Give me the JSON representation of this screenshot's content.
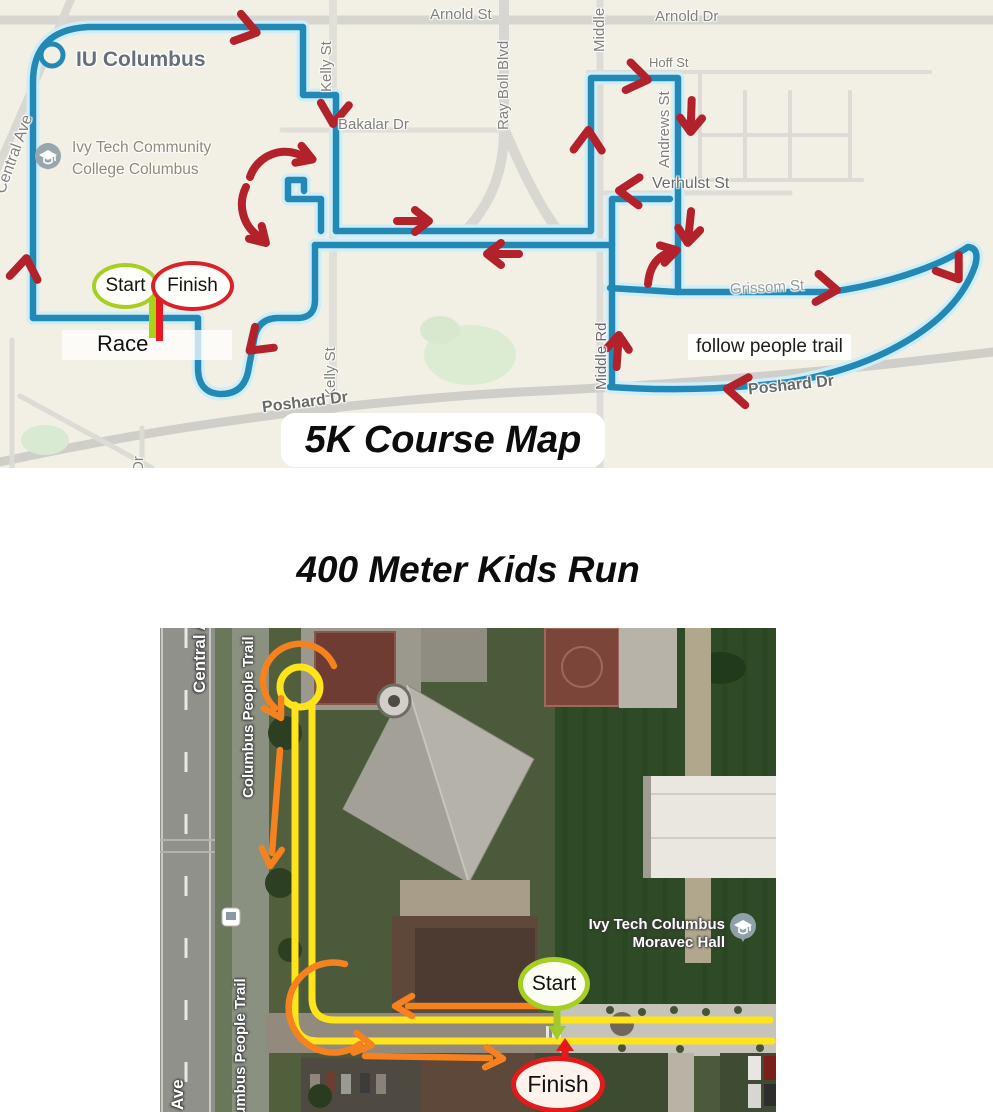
{
  "course_map": {
    "title": "5K Course Map",
    "places": {
      "iu_columbus": "IU Columbus",
      "ivy_tech": "Ivy Tech Community College Columbus",
      "race": "Race",
      "follow_people_trail": "follow people trail"
    },
    "streets": {
      "arnold_st": "Arnold St",
      "arnold_dr": "Arnold Dr",
      "central_ave": "Central Ave",
      "kelly_st_north": "Kelly St",
      "kelly_st_south": "Kelly St",
      "bakalar_dr": "Bakalar Dr",
      "ray_boll_blvd": "Ray Boll Blvd",
      "middle_partial": "Middle",
      "hoff_st": "Hoff St",
      "andrews_st": "Andrews St",
      "verhulst_st": "Verhulst St",
      "grissom_st": "Grissom St",
      "middle_rd": "Middle Rd",
      "poshard_dr_west": "Poshard Dr",
      "poshard_dr_east": "Poshard Dr",
      "dr_partial": "Dr"
    },
    "markers": {
      "start": "Start",
      "finish": "Finish"
    },
    "colors": {
      "route": "#2389b4",
      "route_halo": "#cdeef8",
      "arrow": "#b3212b",
      "start_ring": "#a5d022",
      "finish_ring": "#da2128",
      "map_bg": "#f2efe4"
    }
  },
  "kids_map": {
    "title": "400 Meter Kids Run",
    "labels": {
      "trail_north": "Columbus People Trail",
      "trail_south": "Columbus People Trail",
      "central_ave_north": "Central Ave",
      "central_ave_south": "Ave",
      "hall_line1": "Ivy Tech Columbus",
      "hall_line2": "Moravec Hall"
    },
    "markers": {
      "start": "Start",
      "finish": "Finish"
    },
    "colors": {
      "route": "#ffe41c",
      "arrow": "#f5821f",
      "start_ring": "#a5d022",
      "finish_ring": "#e31a1a"
    }
  }
}
